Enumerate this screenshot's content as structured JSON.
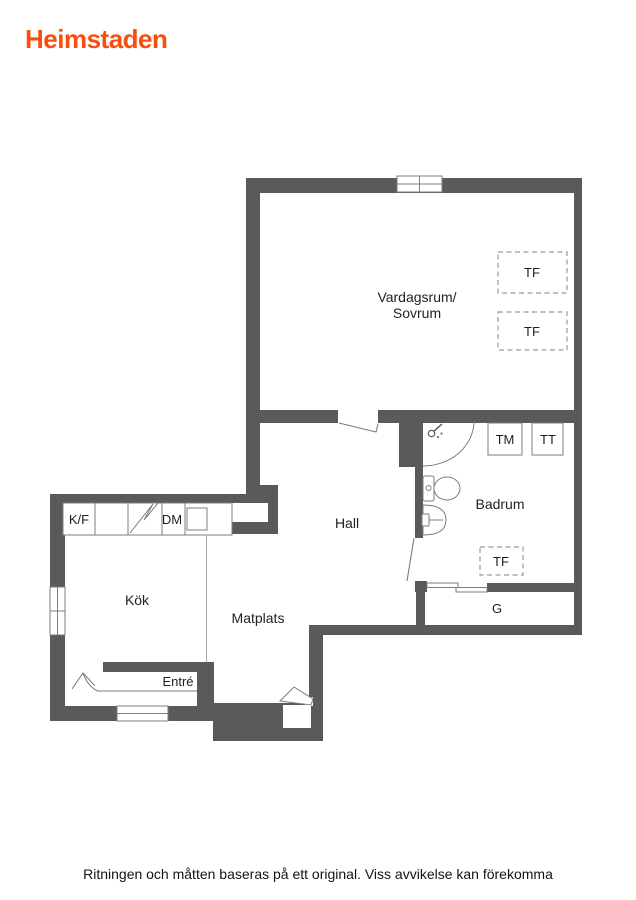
{
  "brand": {
    "name": "Heimstaden",
    "color": "#f94e0e"
  },
  "plan": {
    "rooms": {
      "living_line1": "Vardagsrum/",
      "living_line2": "Sovrum",
      "hall": "Hall",
      "bathroom": "Badrum",
      "kitchen": "Kök",
      "dining": "Matplats",
      "entry": "Entré",
      "wardrobe": "G"
    },
    "fixtures": {
      "fridge_freezer": "K/F",
      "dishwasher": "DM",
      "washing_machine": "TM",
      "tumble_dryer": "TT",
      "tf_living_1": "TF",
      "tf_living_2": "TF",
      "tf_bathroom": "TF"
    },
    "colors": {
      "wall": "#5a5a5a",
      "outline": "#7d7d7d",
      "text": "#1f1f1f"
    }
  },
  "footer": {
    "disclaimer": "Ritningen och måtten baseras på ett original. Viss avvikelse kan förekomma"
  }
}
